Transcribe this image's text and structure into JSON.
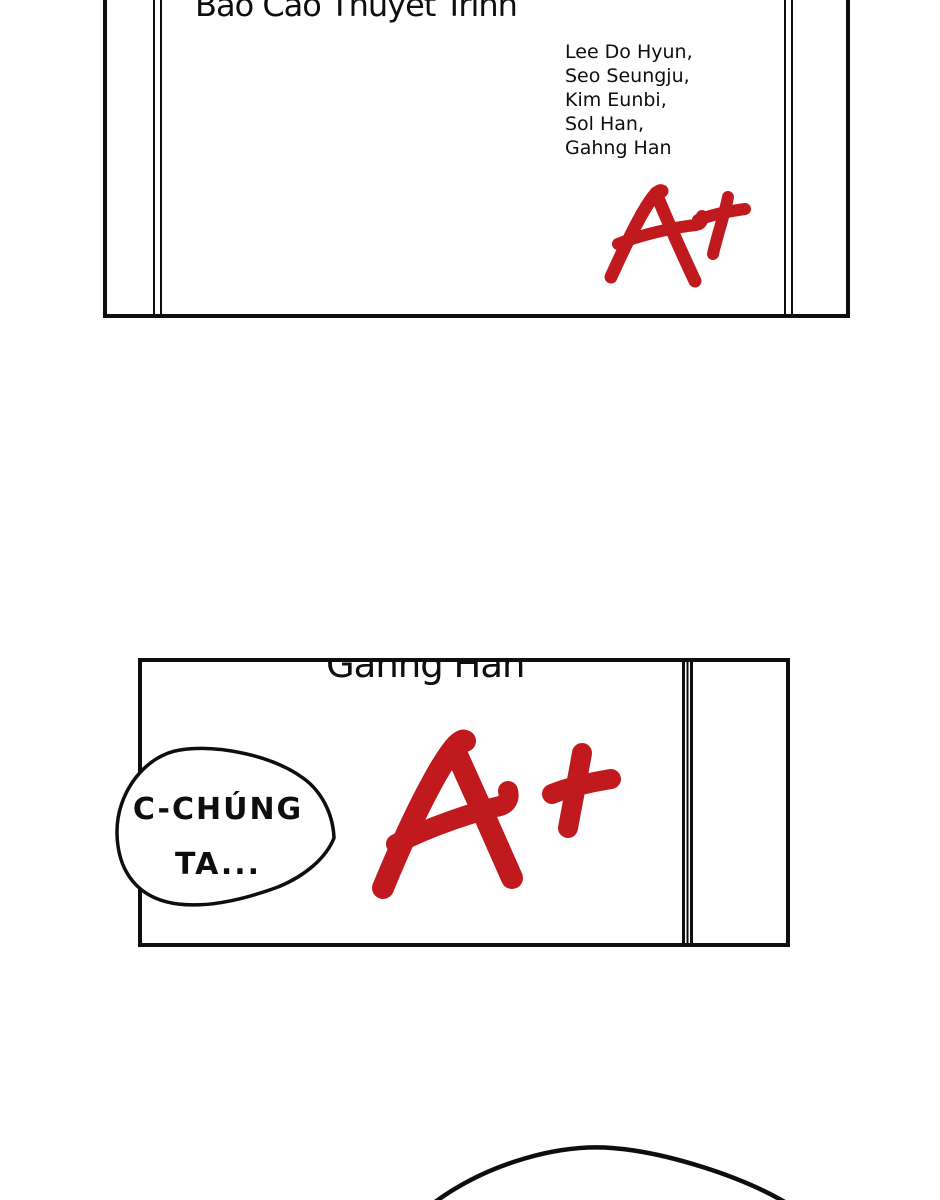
{
  "colors": {
    "ink": "#0e0e0e",
    "grade_red": "#c01a1e",
    "paper": "#ffffff"
  },
  "report": {
    "title": "Báo Cáo Thuyết Trình",
    "authors": [
      "Lee Do Hyun,",
      "Seo Seungju,",
      "Kim Eunbi,",
      "Sol Han,",
      "Gahng Han"
    ],
    "grade": "A+"
  },
  "closeup": {
    "clipped_name": "Gahng Han",
    "grade": "A+"
  },
  "bubble": {
    "line1": "C-CHÚNG",
    "line2": "TA..."
  },
  "icons": {
    "grade_mark": "handwritten-a-plus",
    "head_outline": "character-head-curve"
  }
}
